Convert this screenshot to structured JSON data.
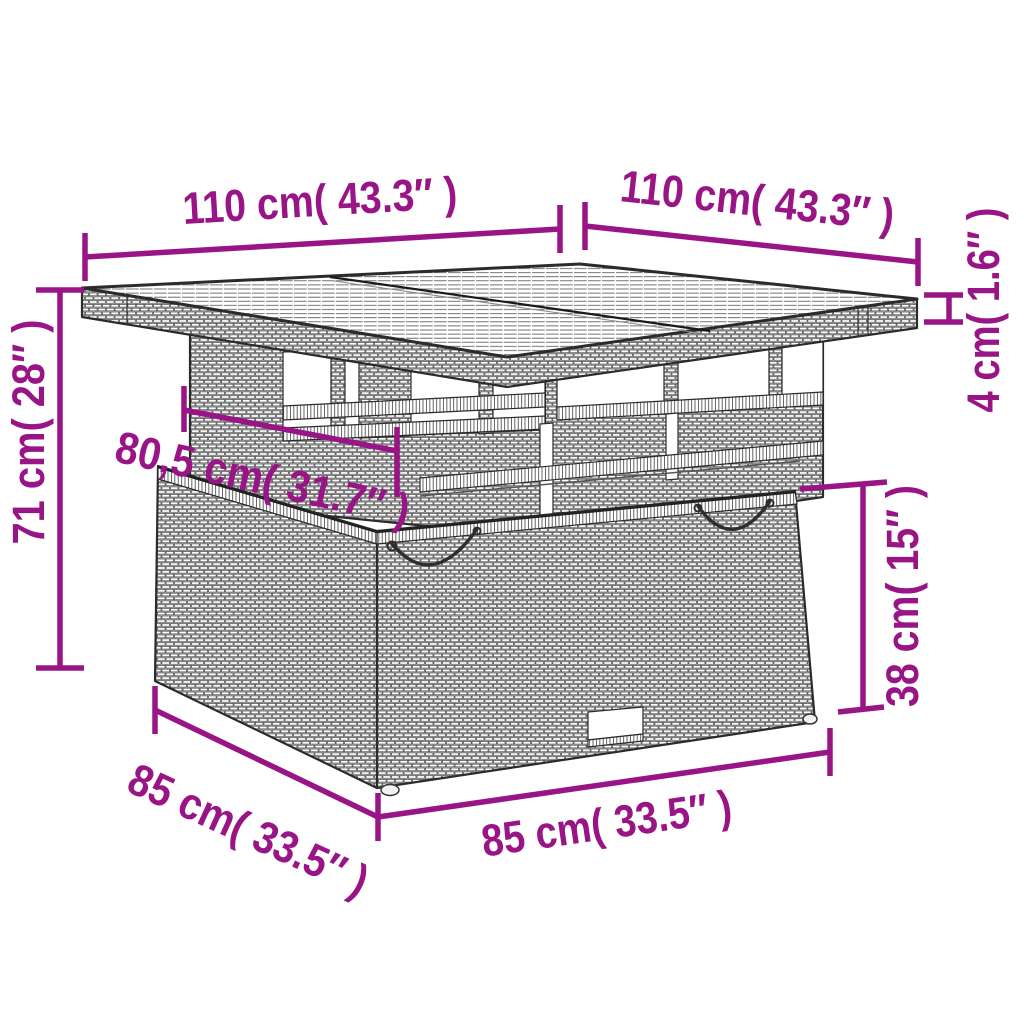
{
  "diagram": {
    "type": "product-dimension-diagram",
    "subject": "rattan lift-top garden table line drawing",
    "colors": {
      "dimension_accent": "#991586",
      "line_art": "#2b2b2b",
      "background": "#ffffff"
    },
    "dimensions": {
      "tabletop_width": "110 cm( 43.3″ )",
      "tabletop_depth": "110 cm( 43.3″ )",
      "tabletop_thickness": "4 cm( 1.6″ )",
      "overall_height": "71 cm( 28″ )",
      "pedestal_width": "80,5 cm( 31.7″ )",
      "base_height": "38 cm( 15″ )",
      "base_depth": "85 cm( 33.5″ )",
      "base_width": "85 cm( 33.5″ )"
    }
  }
}
